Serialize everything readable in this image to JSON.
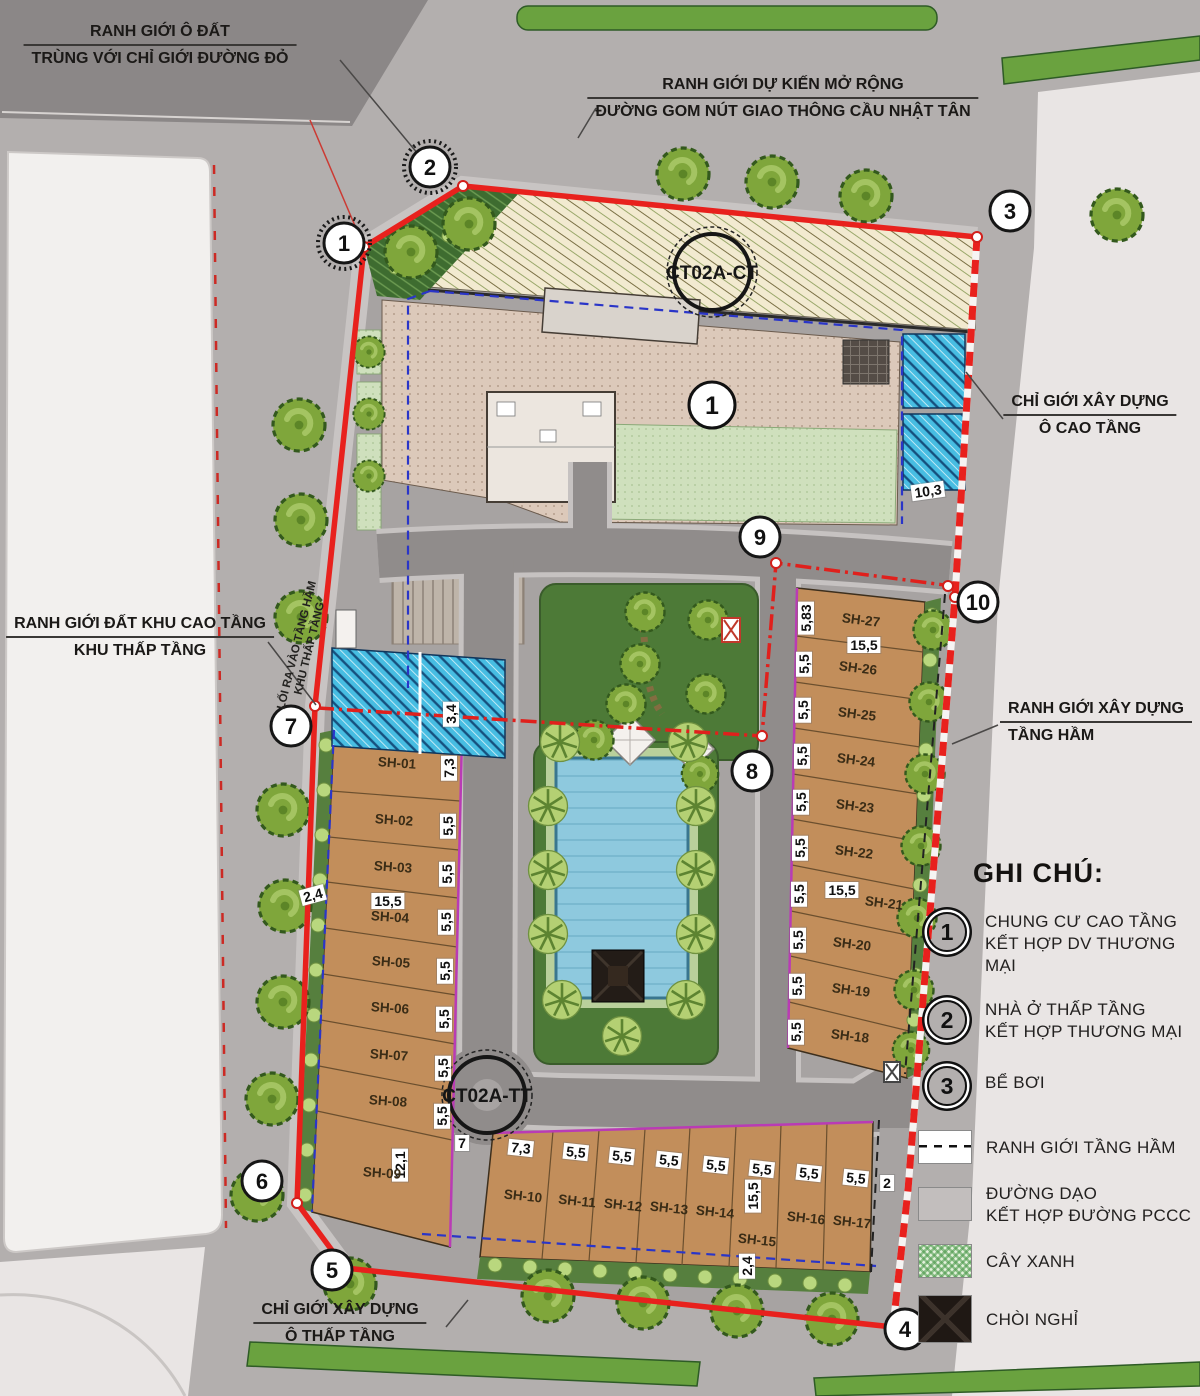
{
  "callouts": {
    "plot": {
      "l1": "RANH GIỚI Ô ĐẤT",
      "l2": "TRÙNG VỚI CHỈ GIỚI ĐƯỜNG ĐỎ"
    },
    "expansion": {
      "l1": "RANH GIỚI DỰ KIẾN MỞ RỘNG",
      "l2": "ĐƯỜNG GOM NÚT GIAO THÔNG CẦU NHẬT TÂN"
    },
    "highrise": {
      "l1": "CHỈ GIỚI XÂY DỰNG",
      "l2": "Ô CAO TẦNG"
    },
    "land": {
      "l1": "RANH GIỚI ĐẤT KHU CAO TẦNG",
      "l2": "KHU THẤP TẦNG"
    },
    "basement": {
      "l1": "RANH GIỚI XÂY DỰNG",
      "l2": "TẦNG HẦM"
    },
    "lowrise": {
      "l1": "CHỈ GIỚI XÂY DỰNG",
      "l2": "Ô THẤP TẦNG"
    },
    "exit": {
      "l1": "LỐI RA VÀO TẦNG HẦM",
      "l2": "KHU THẤP TẦNG"
    }
  },
  "roads": {
    "ct": "CT02A-CT",
    "tt": "CT02A-TT"
  },
  "marker_highrise": "1",
  "points": {
    "p1": "1",
    "p2": "2",
    "p3": "3",
    "p4": "4",
    "p5": "5",
    "p6": "6",
    "p7": "7",
    "p8": "8",
    "p9": "9",
    "p10": "10"
  },
  "dims": {
    "v2": "2",
    "v7": "7",
    "v24": "2,4",
    "v34": "3,4",
    "v55": "5,5",
    "v73": "7,3",
    "v103": "10,3",
    "v121": "12,1",
    "v155": "15,5",
    "v583": "5,83"
  },
  "lots": {
    "sh01": "SH-01",
    "sh02": "SH-02",
    "sh03": "SH-03",
    "sh04": "SH-04",
    "sh05": "SH-05",
    "sh06": "SH-06",
    "sh07": "SH-07",
    "sh08": "SH-08",
    "sh09": "SH-09",
    "sh10": "SH-10",
    "sh11": "SH-11",
    "sh12": "SH-12",
    "sh13": "SH-13",
    "sh14": "SH-14",
    "sh15": "SH-15",
    "sh16": "SH-16",
    "sh17": "SH-17",
    "sh18": "SH-18",
    "sh19": "SH-19",
    "sh20": "SH-20",
    "sh21": "SH-21",
    "sh22": "SH-22",
    "sh23": "SH-23",
    "sh24": "SH-24",
    "sh25": "SH-25",
    "sh26": "SH-26",
    "sh27": "SH-27"
  },
  "legend": {
    "title": "GHI CHÚ:",
    "n1": "1",
    "i1l1": "CHUNG CƯ CAO TẦNG",
    "i1l2": "KẾT HỢP DV THƯƠNG MẠI",
    "n2": "2",
    "i2l1": "NHÀ Ở THẤP TẦNG",
    "i2l2": "KẾT HỢP THƯƠNG MẠI",
    "n3": "3",
    "i3l1": "BỂ BƠI",
    "s1": "RANH GIỚI TẦNG HẦM",
    "s2l1": "ĐƯỜNG DẠO",
    "s2l2": "KẾT HỢP ĐƯỜNG PCCC",
    "s3": "CÂY XANH",
    "s4": "CHÒI NGHỈ"
  },
  "colors": {
    "boundary_red": "#e8211d",
    "lot_tan": "#c28e5b",
    "park_green": "#4d7a37",
    "glass_blue": "#47bde2",
    "edge_magenta": "#b93bb5",
    "road_gray": "#908c8b",
    "tree_green": "#7fa63b",
    "basement_blue": "#2a35c8"
  }
}
